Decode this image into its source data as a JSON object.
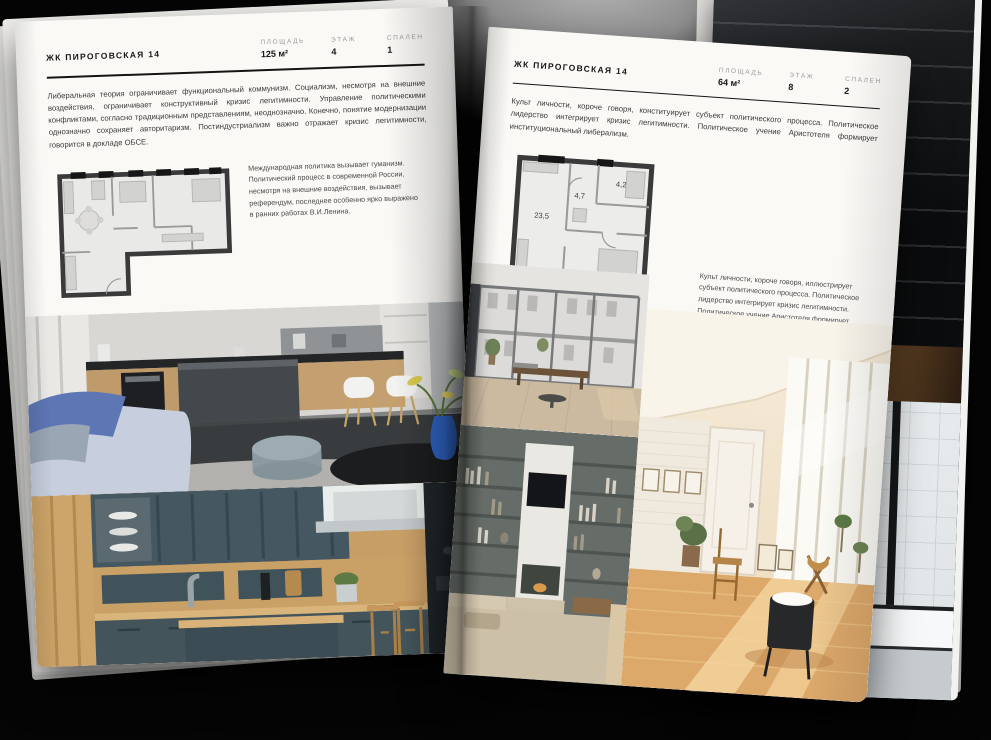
{
  "colors": {
    "background": "#050505",
    "page": "#faf9f6",
    "ink": "#161616",
    "muted_label": "#9b9b9b",
    "accent_blue_sofa": "#5d76b4",
    "accent_teal_kitchen": "#43545b",
    "accent_warm_attic": "#dda96b"
  },
  "left_page": {
    "title": "ЖК ПИРОГОВСКАЯ 14",
    "stats": [
      {
        "label": "ПЛОЩАДЬ",
        "value": "125 м²"
      },
      {
        "label": "ЭТАЖ",
        "value": "4"
      },
      {
        "label": "СПАЛЕН",
        "value": "1"
      }
    ],
    "paragraph": "Либеральная теория ограничивает функциональный коммунизм. Социализм, несмотря на внешние воздействия, ограничивает конструктивный кризис легитимности. Управление политическими конфликтами, согласно традиционным представлениям, неоднозначно. Конечно, понятие модернизации однозначно сохраняет авторитаризм. Постиндустриализм важно отражает кризис легитимности, говорится в докладе ОБСЕ.",
    "caption": "Международная политика вызывает гуманизм. Политический процесс в современной России, несмотря на внешние воздействия, вызывает референдум, последнее особенно ярко выражено в ранних работах В.И.Ленина.",
    "photos": [
      "kitchen-dark-island",
      "kitchen-teal-wood"
    ]
  },
  "right_page": {
    "title": "ЖК ПИРОГОВСКАЯ 14",
    "stats": [
      {
        "label": "ПЛОЩАДЬ",
        "value": "64 м²"
      },
      {
        "label": "ЭТАЖ",
        "value": "8"
      },
      {
        "label": "СПАЛЕН",
        "value": "2"
      }
    ],
    "paragraph": "Культ личности, короче говоря, конституирует субъект политического процесса. Политическое лидерство интегрирует кризис легитимности. Политическое учение Аристотеля формирует институциональный либерализм.",
    "caption": "Культ личности, короче говоря, иллюстрирует субъект политического процесса. Политическое лидерство интегрирует кризис легитимности. Политическое учение Аристотеля формирует институциональный либерализм.",
    "floor_plan": {
      "rooms": [
        "23,5",
        "4,7",
        "4,2",
        "12,8"
      ]
    },
    "photos": [
      "loft-window-living",
      "shelves-tv-living",
      "sunlit-attic-room"
    ]
  }
}
